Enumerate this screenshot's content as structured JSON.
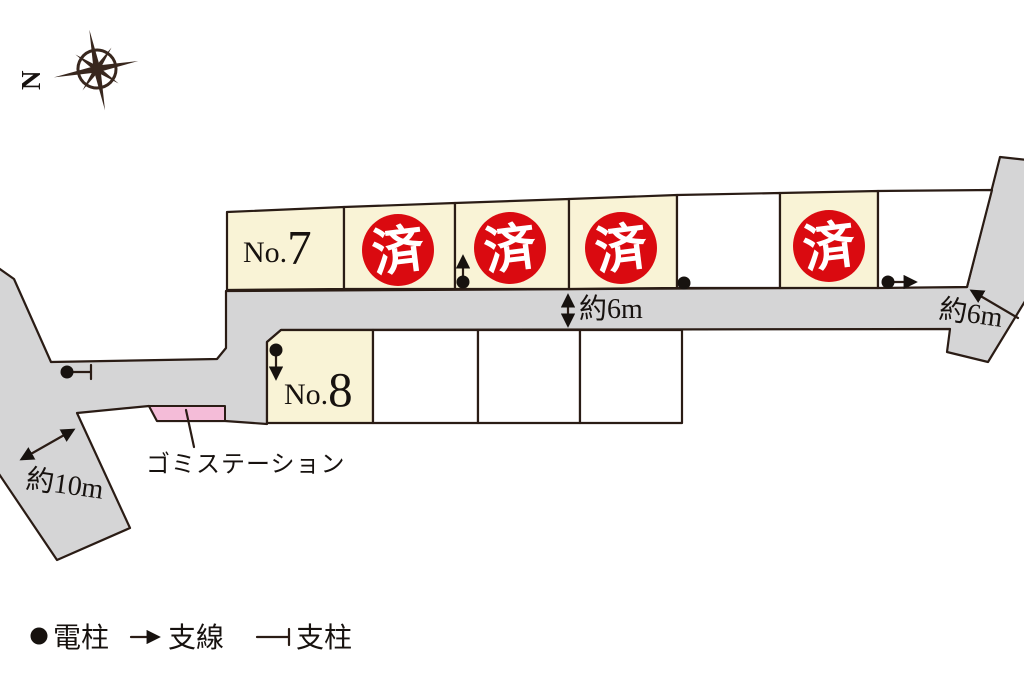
{
  "compass": {
    "north": "N"
  },
  "lots": {
    "top_row": [
      {
        "label": "No.7",
        "prefix": "No.",
        "number": "7",
        "status": "for-sale"
      },
      {
        "label": "",
        "status": "sold",
        "badge": "済"
      },
      {
        "label": "",
        "status": "sold",
        "badge": "済"
      },
      {
        "label": "",
        "status": "sold",
        "badge": "済"
      },
      {
        "label": "",
        "status": "vacant"
      },
      {
        "label": "",
        "status": "sold",
        "badge": "済"
      },
      {
        "label": "",
        "status": "vacant"
      }
    ],
    "bottom_row": [
      {
        "label": "No.8",
        "prefix": "No.",
        "number": "8",
        "status": "for-sale"
      },
      {
        "label": "",
        "status": "vacant"
      },
      {
        "label": "",
        "status": "vacant"
      },
      {
        "label": "",
        "status": "vacant"
      }
    ]
  },
  "annotations": {
    "road_width_center": "約6m",
    "road_width_east": "約6m",
    "road_width_southwest": "約10m",
    "garbage_station": "ゴミステーション"
  },
  "legend": {
    "utility_pole": "電柱",
    "guy_wire": "支線",
    "support_pole": "支柱"
  },
  "colors": {
    "road_gray": "#d5d5d6",
    "lot_cream": "#f9f3d6",
    "sold_red": "#da0a10",
    "garbage_pink": "#f4bcd8",
    "line_dark": "#2a1c15"
  }
}
